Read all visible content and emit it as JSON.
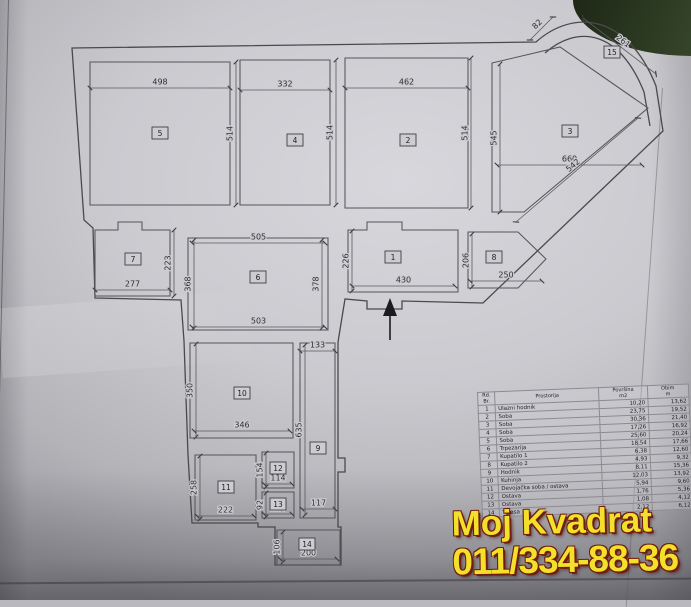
{
  "watermark": {
    "line1": "Moj Kvadrat",
    "line2": "011/334-88-36",
    "color": "#f2e02a",
    "outline": "#701d0e"
  },
  "plan": {
    "rooms": [
      {
        "n": "5",
        "x": 160,
        "y": 133
      },
      {
        "n": "4",
        "x": 295,
        "y": 140
      },
      {
        "n": "2",
        "x": 408,
        "y": 140
      },
      {
        "n": "3",
        "x": 570,
        "y": 131
      },
      {
        "n": "15",
        "x": 612,
        "y": 52
      },
      {
        "n": "7",
        "x": 133,
        "y": 259
      },
      {
        "n": "6",
        "x": 258,
        "y": 277
      },
      {
        "n": "1",
        "x": 393,
        "y": 257
      },
      {
        "n": "8",
        "x": 494,
        "y": 257
      },
      {
        "n": "10",
        "x": 242,
        "y": 393
      },
      {
        "n": "9",
        "x": 318,
        "y": 448
      },
      {
        "n": "11",
        "x": 226,
        "y": 487
      },
      {
        "n": "12",
        "x": 278,
        "y": 468
      },
      {
        "n": "13",
        "x": 278,
        "y": 504
      },
      {
        "n": "14",
        "x": 307,
        "y": 544
      }
    ],
    "dims": [
      {
        "t": "498",
        "x1": 90,
        "y1": 88,
        "x2": 230,
        "y2": 88
      },
      {
        "t": "332",
        "x1": 240,
        "y1": 90,
        "x2": 330,
        "y2": 90
      },
      {
        "t": "462",
        "x1": 345,
        "y1": 88,
        "x2": 468,
        "y2": 88
      },
      {
        "t": "514",
        "x1": 236,
        "y1": 205,
        "x2": 236,
        "y2": 62
      },
      {
        "t": "514",
        "x1": 336,
        "y1": 205,
        "x2": 336,
        "y2": 60
      },
      {
        "t": "514",
        "x1": 471,
        "y1": 208,
        "x2": 471,
        "y2": 58
      },
      {
        "t": "545",
        "x1": 500,
        "y1": 212,
        "x2": 500,
        "y2": 64
      },
      {
        "t": "660",
        "x1": 497,
        "y1": 165,
        "x2": 642,
        "y2": 165
      },
      {
        "t": "542",
        "x1": 638,
        "y1": 118,
        "x2": 516,
        "y2": 222
      },
      {
        "t": "82",
        "x1": 530,
        "y1": 40,
        "x2": 553,
        "y2": 17
      },
      {
        "t": "261",
        "x1": 583,
        "y1": 18,
        "x2": 656,
        "y2": 74
      },
      {
        "t": "223",
        "x1": 174,
        "y1": 296,
        "x2": 174,
        "y2": 230
      },
      {
        "t": "277",
        "x1": 95,
        "y1": 290,
        "x2": 170,
        "y2": 290
      },
      {
        "t": "505",
        "x1": 192,
        "y1": 243,
        "x2": 325,
        "y2": 243
      },
      {
        "t": "368",
        "x1": 194,
        "y1": 328,
        "x2": 194,
        "y2": 240
      },
      {
        "t": "378",
        "x1": 322,
        "y1": 328,
        "x2": 322,
        "y2": 240
      },
      {
        "t": "503",
        "x1": 192,
        "y1": 327,
        "x2": 325,
        "y2": 327
      },
      {
        "t": "226",
        "x1": 352,
        "y1": 291,
        "x2": 352,
        "y2": 231
      },
      {
        "t": "430",
        "x1": 352,
        "y1": 286,
        "x2": 455,
        "y2": 286
      },
      {
        "t": "206",
        "x1": 472,
        "y1": 287,
        "x2": 472,
        "y2": 234
      },
      {
        "t": "250",
        "x1": 470,
        "y1": 281,
        "x2": 542,
        "y2": 281
      },
      {
        "t": "133",
        "x1": 300,
        "y1": 351,
        "x2": 335,
        "y2": 351
      },
      {
        "t": "350",
        "x1": 196,
        "y1": 437,
        "x2": 196,
        "y2": 344
      },
      {
        "t": "346",
        "x1": 194,
        "y1": 431,
        "x2": 290,
        "y2": 431
      },
      {
        "t": "635",
        "x1": 305,
        "y1": 515,
        "x2": 305,
        "y2": 345
      },
      {
        "t": "258",
        "x1": 200,
        "y1": 519,
        "x2": 200,
        "y2": 456
      },
      {
        "t": "222",
        "x1": 197,
        "y1": 516,
        "x2": 254,
        "y2": 516
      },
      {
        "t": "154",
        "x1": 266,
        "y1": 487,
        "x2": 266,
        "y2": 453
      },
      {
        "t": "114",
        "x1": 264,
        "y1": 484,
        "x2": 292,
        "y2": 484
      },
      {
        "t": "92",
        "x1": 266,
        "y1": 517,
        "x2": 266,
        "y2": 493
      },
      {
        "t": "114",
        "x1": 264,
        "y1": 514,
        "x2": 292,
        "y2": 514
      },
      {
        "t": "117",
        "x1": 302,
        "y1": 509,
        "x2": 335,
        "y2": 509
      },
      {
        "t": "106",
        "x1": 283,
        "y1": 562,
        "x2": 283,
        "y2": 532
      },
      {
        "t": "200",
        "x1": 280,
        "y1": 559,
        "x2": 337,
        "y2": 559
      }
    ]
  },
  "table": {
    "header": {
      "rb1": "Rd.",
      "rb2": "Br.",
      "room": "Prostorija",
      "area1": "Površina",
      "area2": "m2",
      "perim1": "Obim",
      "perim2": "m"
    },
    "rows": [
      [
        "1",
        "Ulazni hodnik",
        "10,20",
        "13,62"
      ],
      [
        "2",
        "Soba",
        "23,75",
        "19,52"
      ],
      [
        "3",
        "Soba",
        "30,36",
        "21,40"
      ],
      [
        "4",
        "Soba",
        "17,26",
        "16,92"
      ],
      [
        "5",
        "Soba",
        "25,60",
        "20,24"
      ],
      [
        "6",
        "Trpezarija",
        "18,54",
        "17,66"
      ],
      [
        "7",
        "Kupatilo 1",
        "6,38",
        "12,60"
      ],
      [
        "8",
        "Kupatilo 2",
        "4,93",
        "9,32"
      ],
      [
        "9",
        "Hodnik",
        "8,11",
        "15,36"
      ],
      [
        "10",
        "Kuhinja",
        "12,03",
        "13,92"
      ],
      [
        "11",
        "Devojačka soba / ostava",
        "5,94",
        "9,60"
      ],
      [
        "12",
        "Ostava",
        "1,76",
        "5,36"
      ],
      [
        "13",
        "Ostava",
        "1,08",
        "4,12"
      ],
      [
        "14",
        "Terasa",
        "2,12",
        "6,12"
      ]
    ]
  }
}
